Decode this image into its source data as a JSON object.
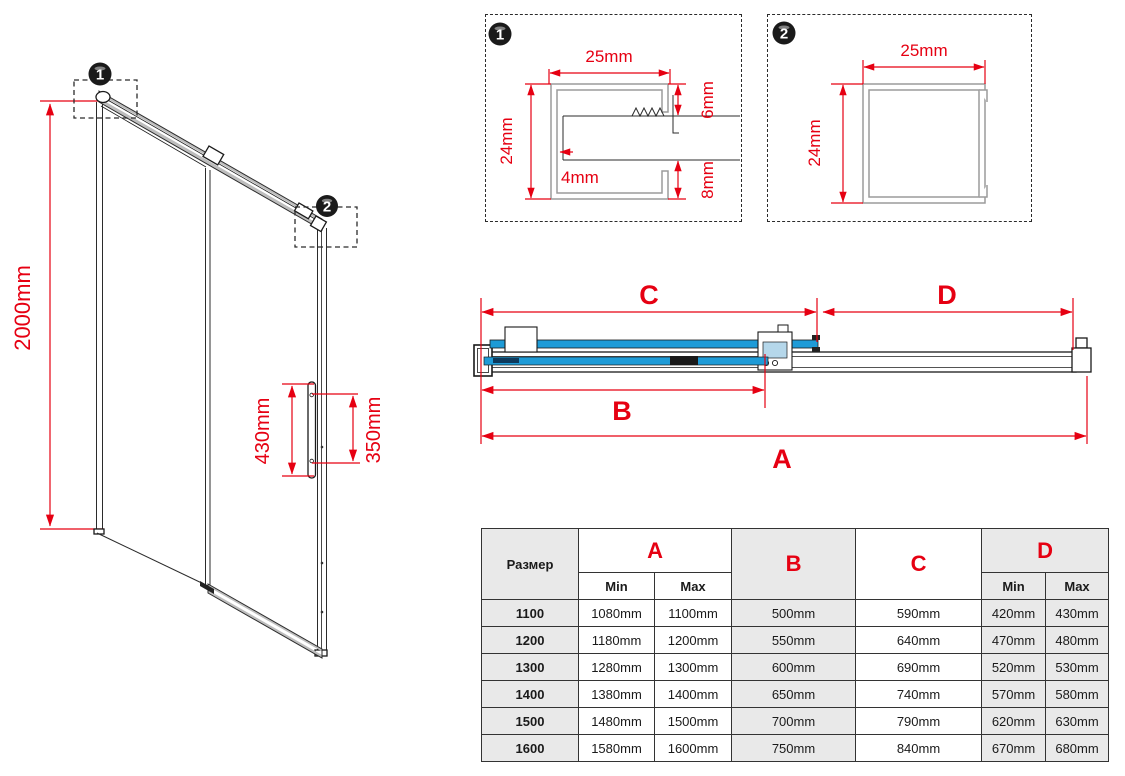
{
  "colors": {
    "dimension_red": "#e60012",
    "glass_blue": "#1e9bd7",
    "roller_light_blue": "#b5d7ea",
    "rail_gray": "#bdbdbd",
    "table_cell_gray": "#e9e9e9",
    "line_black": "#1a1a1a"
  },
  "door_view": {
    "callout_1": "1",
    "callout_2": "2",
    "height": "2000mm",
    "handle_length": "430mm",
    "handle_hole_spacing": "350mm"
  },
  "detail_1": {
    "badge": "1",
    "width": "25mm",
    "height": "24mm",
    "top_flange": "6mm",
    "glass_gap": "4mm",
    "bottom_flange": "8mm"
  },
  "detail_2": {
    "badge": "2",
    "width": "25mm",
    "height": "24mm"
  },
  "section_view": {
    "a": "A",
    "b": "B",
    "c": "C",
    "d": "D"
  },
  "table": {
    "size_header": "Размер",
    "col_a": "A",
    "col_b": "B",
    "col_c": "C",
    "col_d": "D",
    "min_label": "Min",
    "max_label": "Max",
    "rows": [
      {
        "size": "1100",
        "a_min": "1080mm",
        "a_max": "1100mm",
        "b": "500mm",
        "c": "590mm",
        "d_min": "420mm",
        "d_max": "430mm"
      },
      {
        "size": "1200",
        "a_min": "1180mm",
        "a_max": "1200mm",
        "b": "550mm",
        "c": "640mm",
        "d_min": "470mm",
        "d_max": "480mm"
      },
      {
        "size": "1300",
        "a_min": "1280mm",
        "a_max": "1300mm",
        "b": "600mm",
        "c": "690mm",
        "d_min": "520mm",
        "d_max": "530mm"
      },
      {
        "size": "1400",
        "a_min": "1380mm",
        "a_max": "1400mm",
        "b": "650mm",
        "c": "740mm",
        "d_min": "570mm",
        "d_max": "580mm"
      },
      {
        "size": "1500",
        "a_min": "1480mm",
        "a_max": "1500mm",
        "b": "700mm",
        "c": "790mm",
        "d_min": "620mm",
        "d_max": "630mm"
      },
      {
        "size": "1600",
        "a_min": "1580mm",
        "a_max": "1600mm",
        "b": "750mm",
        "c": "840mm",
        "d_min": "670mm",
        "d_max": "680mm"
      }
    ]
  }
}
